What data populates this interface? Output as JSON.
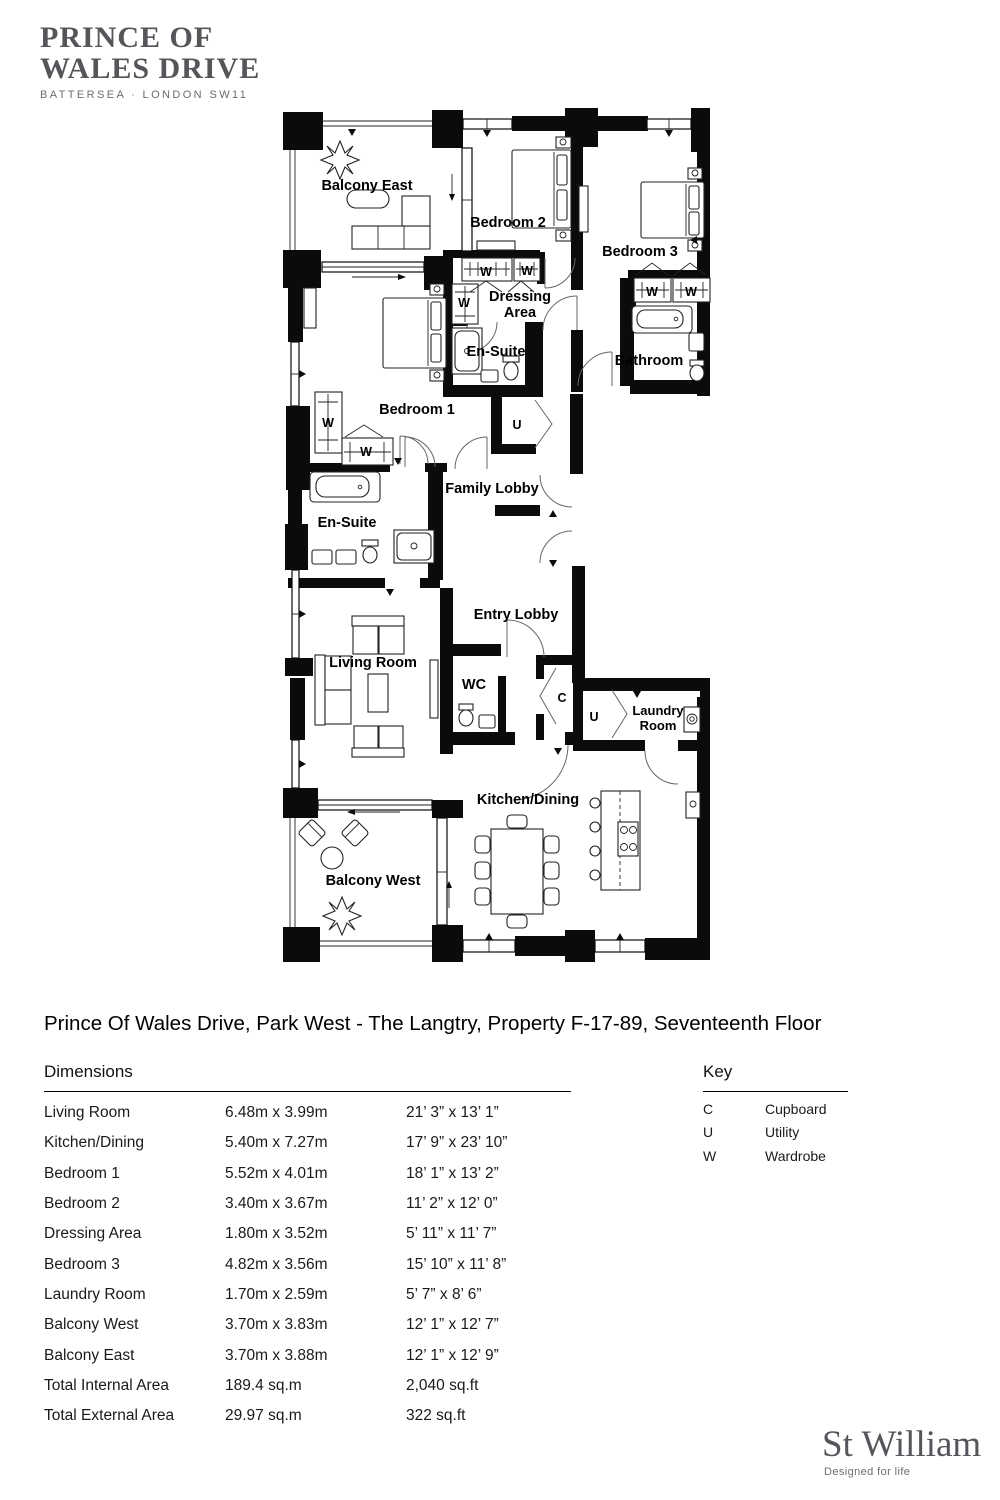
{
  "brand": {
    "line1": "PRINCE OF",
    "line2": "WALES DRIVE",
    "subtitle": "BATTERSEA · LONDON SW11"
  },
  "title": "Prince Of Wales Drive, Park West - The Langtry, Property F-17-89, Seventeenth Floor",
  "plan": {
    "labels": [
      {
        "id": "balcony-east",
        "text": "Balcony East"
      },
      {
        "id": "bedroom-2",
        "text": "Bedroom 2"
      },
      {
        "id": "bedroom-3",
        "text": "Bedroom 3"
      },
      {
        "id": "dressing-line1",
        "text": "Dressing"
      },
      {
        "id": "dressing-line2",
        "text": "Area"
      },
      {
        "id": "en-suite-top",
        "text": "En-Suite"
      },
      {
        "id": "bathroom",
        "text": "Bathroom"
      },
      {
        "id": "bedroom-1",
        "text": "Bedroom 1"
      },
      {
        "id": "family-lobby",
        "text": "Family Lobby"
      },
      {
        "id": "en-suite-left",
        "text": "En-Suite"
      },
      {
        "id": "entry-lobby",
        "text": "Entry Lobby"
      },
      {
        "id": "living-room",
        "text": "Living Room"
      },
      {
        "id": "wc",
        "text": "WC"
      },
      {
        "id": "kitchen-dining",
        "text": "Kitchen/Dining"
      },
      {
        "id": "balcony-west",
        "text": "Balcony West"
      },
      {
        "id": "laundry-line1",
        "text": "Laundry"
      },
      {
        "id": "laundry-line2",
        "text": "Room"
      },
      {
        "id": "u-cupboard",
        "text": "U"
      },
      {
        "id": "c-cupboard",
        "text": "C"
      },
      {
        "id": "u-laundry",
        "text": "U"
      },
      {
        "id": "w-dressing-1",
        "text": "W"
      },
      {
        "id": "w-dressing-2",
        "text": "W"
      },
      {
        "id": "w-dressing-3",
        "text": "W"
      },
      {
        "id": "w-bedroom1-1",
        "text": "W"
      },
      {
        "id": "w-bedroom1-2",
        "text": "W"
      },
      {
        "id": "w-bedroom3-1",
        "text": "W"
      },
      {
        "id": "w-bedroom3-2",
        "text": "W"
      }
    ]
  },
  "dimensions": {
    "header": "Dimensions",
    "rows": [
      {
        "name": "Living Room",
        "metric": "6.48m x 3.99m",
        "imperial": "21’ 3” x 13’ 1”"
      },
      {
        "name": "Kitchen/Dining",
        "metric": "5.40m x 7.27m",
        "imperial": "17’ 9” x 23’ 10”"
      },
      {
        "name": "Bedroom 1",
        "metric": "5.52m x 4.01m",
        "imperial": "18’ 1” x 13’ 2”"
      },
      {
        "name": "Bedroom 2",
        "metric": "3.40m x 3.67m",
        "imperial": "11’ 2” x 12’ 0”"
      },
      {
        "name": "Dressing Area",
        "metric": "1.80m x 3.52m",
        "imperial": "5’ 11” x 11’ 7”"
      },
      {
        "name": "Bedroom 3",
        "metric": "4.82m x 3.56m",
        "imperial": "15’ 10” x 11’ 8”"
      },
      {
        "name": "Laundry Room",
        "metric": "1.70m x 2.59m",
        "imperial": "5’ 7” x 8’ 6”"
      },
      {
        "name": "Balcony West",
        "metric": "3.70m x 3.83m",
        "imperial": "12’ 1” x 12’ 7”"
      },
      {
        "name": "Balcony East",
        "metric": "3.70m x 3.88m",
        "imperial": "12’ 1” x 12’ 9”"
      },
      {
        "name": "Total Internal Area",
        "metric": "189.4 sq.m",
        "imperial": "2,040 sq.ft"
      },
      {
        "name": "Total External Area",
        "metric": "29.97 sq.m",
        "imperial": "322 sq.ft"
      }
    ]
  },
  "key": {
    "header": "Key",
    "items": [
      {
        "code": "C",
        "label": "Cupboard"
      },
      {
        "code": "U",
        "label": "Utility"
      },
      {
        "code": "W",
        "label": "Wardrobe"
      }
    ]
  },
  "footer": {
    "brand": "St William",
    "tagline": "Designed for life"
  },
  "colors": {
    "brand_gray": "#54565a",
    "line_black": "#0b0b0b"
  }
}
